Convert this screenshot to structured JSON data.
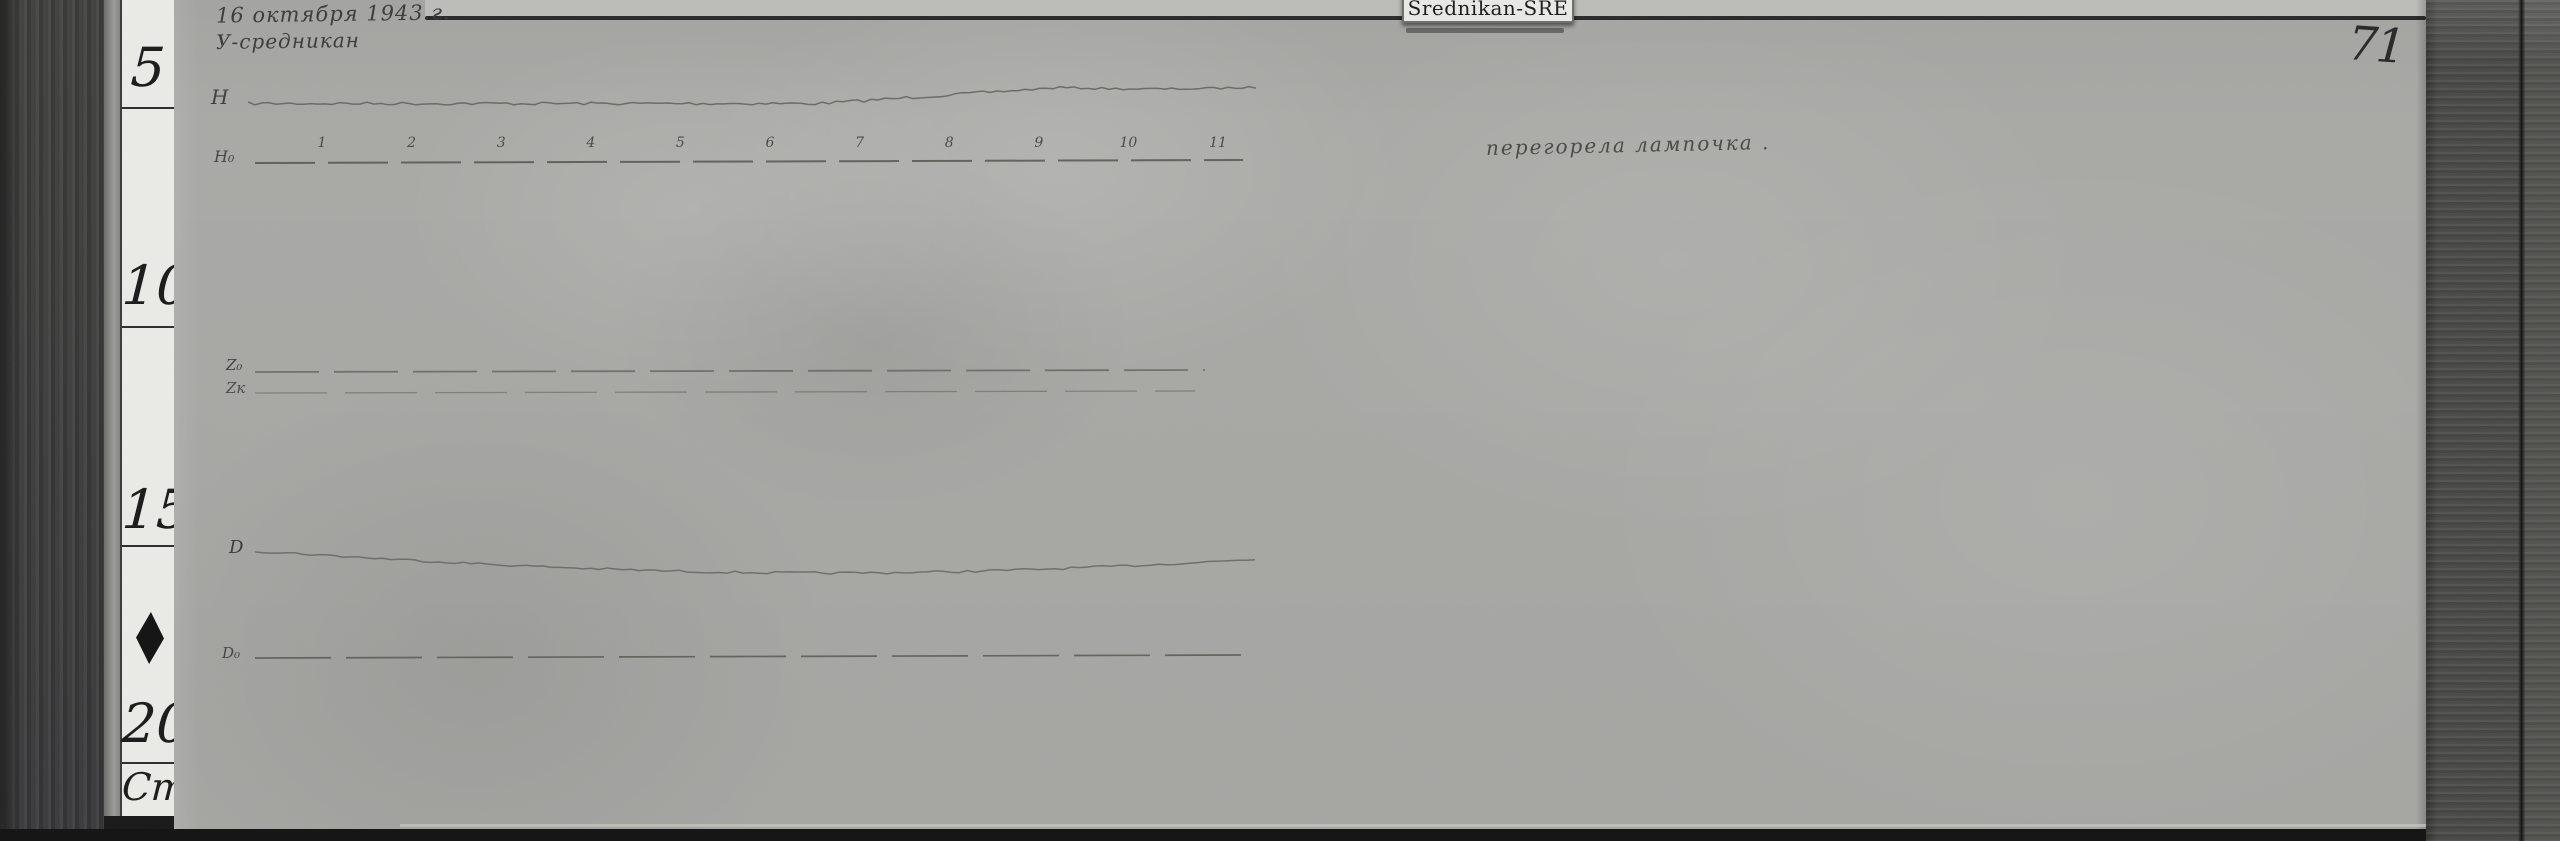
{
  "photo": {
    "label_tag": "Srednikan-SRE",
    "page_number": "71",
    "handwriting": {
      "date_line": "16 октября 1943 г.",
      "station_line": "У-средникан",
      "note": "перегорела лампочка ."
    },
    "trace_labels": {
      "h": "H",
      "h0": "Н₀",
      "z0": "Z₀",
      "zk": "Zк",
      "d": "D",
      "d0": "D₀"
    },
    "hour_marks": [
      "1",
      "2",
      "3",
      "4",
      "5",
      "6",
      "7",
      "8",
      "9",
      "10",
      "11"
    ],
    "ruler": {
      "marks": [
        "5",
        "10",
        "15",
        "20"
      ],
      "unit": "Cm",
      "diamond_icon": "diamond"
    },
    "colors": {
      "sheet_gray": "#a9a9a6",
      "ruler_face": "#eaeae6",
      "wood_left": "#3b3b3b",
      "wood_right": "#4b4b48",
      "ink": "#3c3c3c",
      "trace": "#60605c"
    }
  }
}
